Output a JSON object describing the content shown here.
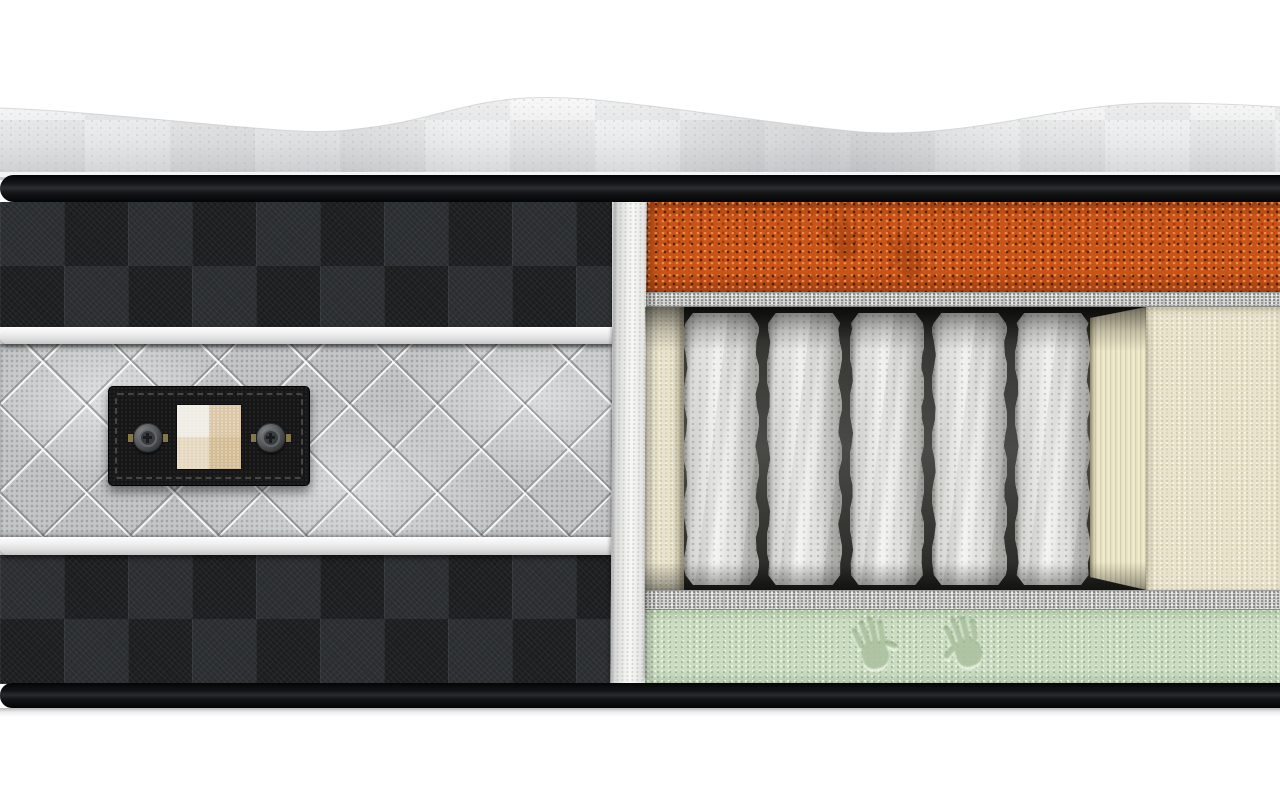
{
  "scene": {
    "subject": "hybrid mattress cutaway 3d render",
    "background": "#ffffff"
  },
  "top_cover": {
    "name": "quilted knit wavy top cover",
    "color_light": "#f8f8f9",
    "color_shaded": "#d2d4d6"
  },
  "borders": {
    "top_tape_color": "#17191c",
    "base_tape_color": "#141619"
  },
  "side_panel": {
    "checker_dark": "#1b1d1f",
    "checker_light": "#2a2d30",
    "piping_color": "#f0f0f0",
    "quilt_color": "#c3c5c7"
  },
  "label": {
    "background": "#161616",
    "stitch_color": "#454545",
    "button_count": 2,
    "button_color": "#55585b",
    "swatch": {
      "top_left": "#efece3",
      "top_right": "#dbc7a6",
      "bottom_left": "#e6d7bf",
      "bottom_right": "#d3bb94"
    }
  },
  "cut_edge": {
    "color": "#f2f2f1"
  },
  "layers": {
    "comfort_foam": {
      "label": "orange comfort foam",
      "color": "#c85418",
      "handprints": 2,
      "handprint_color": "#4a1504"
    },
    "felt_top": {
      "label": "insulator felt pad",
      "color": "#d2d2d0"
    },
    "springs": {
      "label": "pocket spring core",
      "count": 5,
      "fabric_color": "#ececeb",
      "gap_color": "#23231f"
    },
    "encasement": {
      "label": "foam encasement rail",
      "color": "#e9e3cd"
    },
    "felt_bottom": {
      "label": "insulator felt pad",
      "color": "#d2d2d0"
    },
    "base_foam": {
      "label": "green base memory foam",
      "color": "#cbdcc2",
      "handprints": 2,
      "handprint_color": "#6d8f5c"
    }
  }
}
